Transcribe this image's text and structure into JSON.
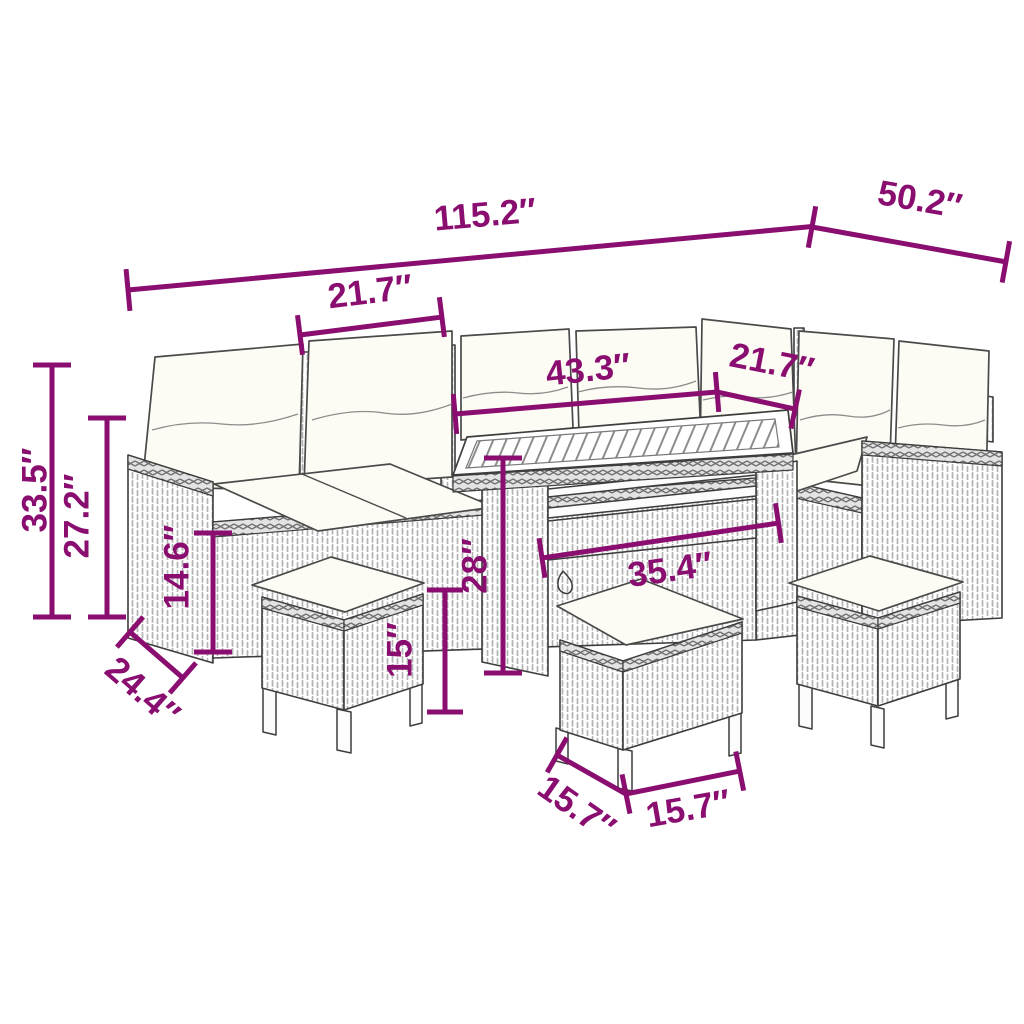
{
  "meta": {
    "title": "Garden furniture set dimension diagram",
    "unit": "inches",
    "accent_color": "#8A0E70",
    "outline_color": "#3d3d3d",
    "background_color": "#ffffff"
  },
  "dimensions": {
    "overall_width": "115.2″",
    "overall_depth": "50.2″",
    "left_seat_section_width": "21.7″",
    "table_top_length": "43.3″",
    "right_seat_section_width": "21.7″",
    "total_height": "33.5″",
    "backrest_height": "27.2″",
    "armrest_height": "14.6″",
    "table_height": "28″",
    "stool_height": "15″",
    "table_base_length": "35.4″",
    "sofa_depth": "24.4″",
    "stool_depth": "15.7″",
    "stool_width": "15.7″"
  }
}
